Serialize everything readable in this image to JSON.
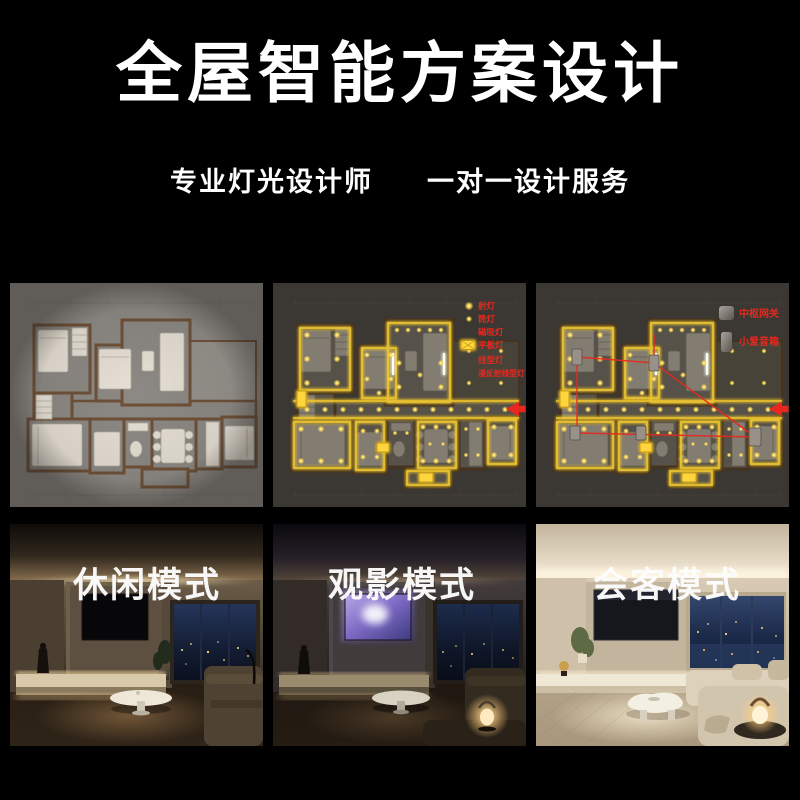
{
  "header": {
    "title": "全屋智能方案设计",
    "subtitle": [
      "专业灯光设计师",
      "一对一设计服务"
    ]
  },
  "floorplan_section": {
    "panels": [
      {
        "name": "base-floor-plan"
      },
      {
        "name": "lighting-layout-plan"
      },
      {
        "name": "smart-device-layout-plan"
      }
    ],
    "light_legend": {
      "items": [
        {
          "label": "射灯",
          "icon": "spotlight-dot"
        },
        {
          "label": "筒灯",
          "icon": "downlight-dot"
        },
        {
          "label": "磁吸灯",
          "icon": "magnetic-track-bar"
        },
        {
          "label": "平板灯",
          "icon": "panel-light-rect"
        },
        {
          "label": "线型灯",
          "icon": "linear-light-line"
        },
        {
          "label": "漫反射线型灯",
          "icon": "diffuse-linear-light-line"
        }
      ]
    },
    "device_legend": {
      "items": [
        {
          "label": "中枢网关",
          "icon": "hub-gateway"
        },
        {
          "label": "小爱音箱",
          "icon": "smart-speaker"
        }
      ]
    }
  },
  "modes": {
    "items": [
      {
        "label": "休闲模式"
      },
      {
        "label": "观影模式"
      },
      {
        "label": "会客模式"
      }
    ]
  },
  "colors": {
    "background": "#000000",
    "title_text": "#ffffff",
    "legend_red": "#e8281e",
    "arrow_red": "#e8281e",
    "light_glow": "#ffd53e"
  }
}
